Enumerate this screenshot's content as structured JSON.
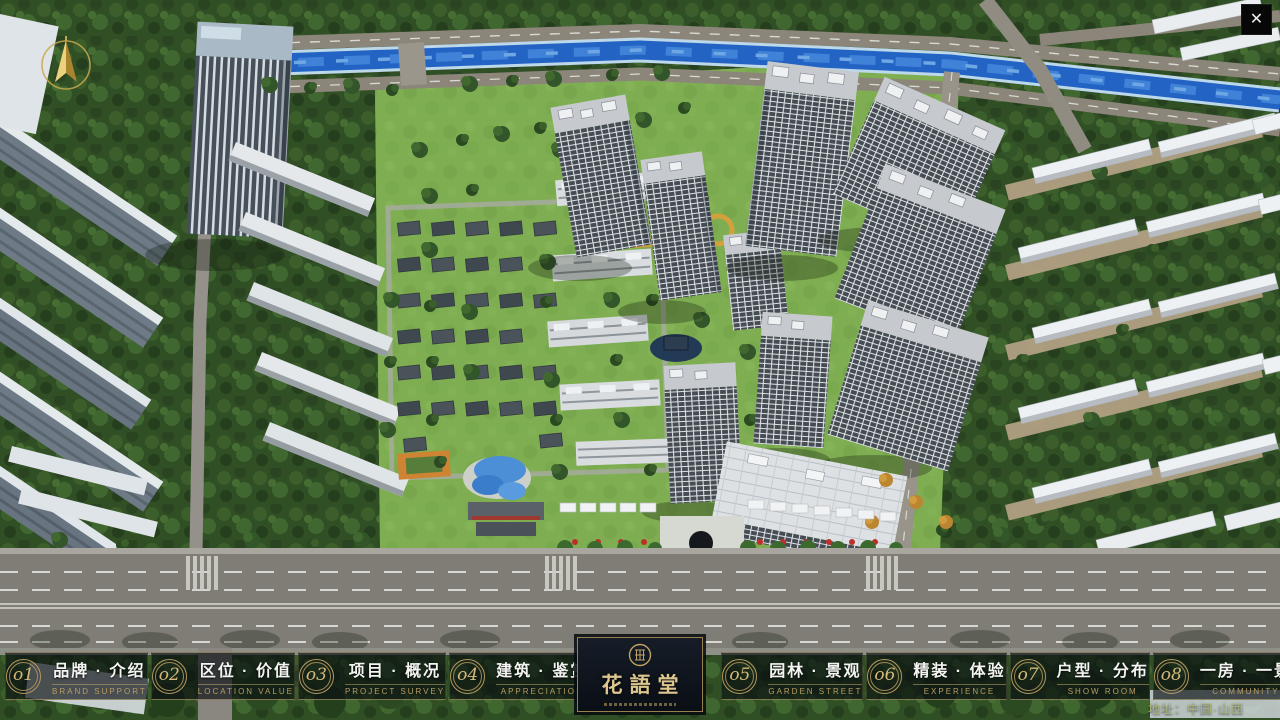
{
  "window": {
    "close_glyph": "✕"
  },
  "logo": {
    "title": "花語堂"
  },
  "footer": {
    "address": "地址：中国·山西"
  },
  "nav": {
    "items": [
      {
        "num": "o1",
        "title": "品牌 · 介绍",
        "subtitle": "BRAND SUPPORT"
      },
      {
        "num": "o2",
        "title": "区位 · 价值",
        "subtitle": "LOCATION VALUE"
      },
      {
        "num": "o3",
        "title": "项目 · 概况",
        "subtitle": "PROJECT SURVEY"
      },
      {
        "num": "o4",
        "title": "建筑 · 鉴赏",
        "subtitle": "APPRECIATION"
      },
      {
        "num": "o5",
        "title": "园林 · 景观",
        "subtitle": "GARDEN STREET"
      },
      {
        "num": "o6",
        "title": "精装 · 体验",
        "subtitle": "EXPERIENCE"
      },
      {
        "num": "o7",
        "title": "户型 · 分布",
        "subtitle": "SHOW ROOM"
      },
      {
        "num": "o8",
        "title": "一房 · 一景",
        "subtitle": "COMMUNITY"
      }
    ]
  },
  "colors": {
    "accent_gold": "#c0a368",
    "bar_background": "rgba(8,12,16,0.66)",
    "logo_panel": "#0d1219",
    "river_blue": "#2263c4",
    "lawn_green": "#7fae52"
  }
}
